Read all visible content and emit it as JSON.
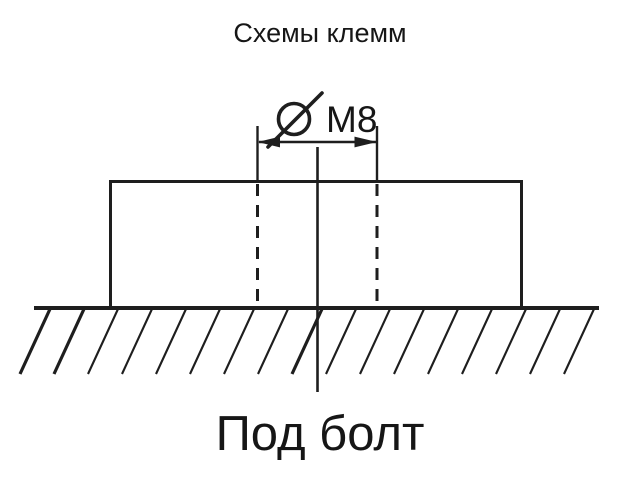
{
  "title": "Схемы клемм",
  "dimension": {
    "symbol": "⌀",
    "label": "M8"
  },
  "caption": "Под болт",
  "colors": {
    "line": "#1e1e1e",
    "text": "#161616",
    "background": "#ffffff"
  }
}
